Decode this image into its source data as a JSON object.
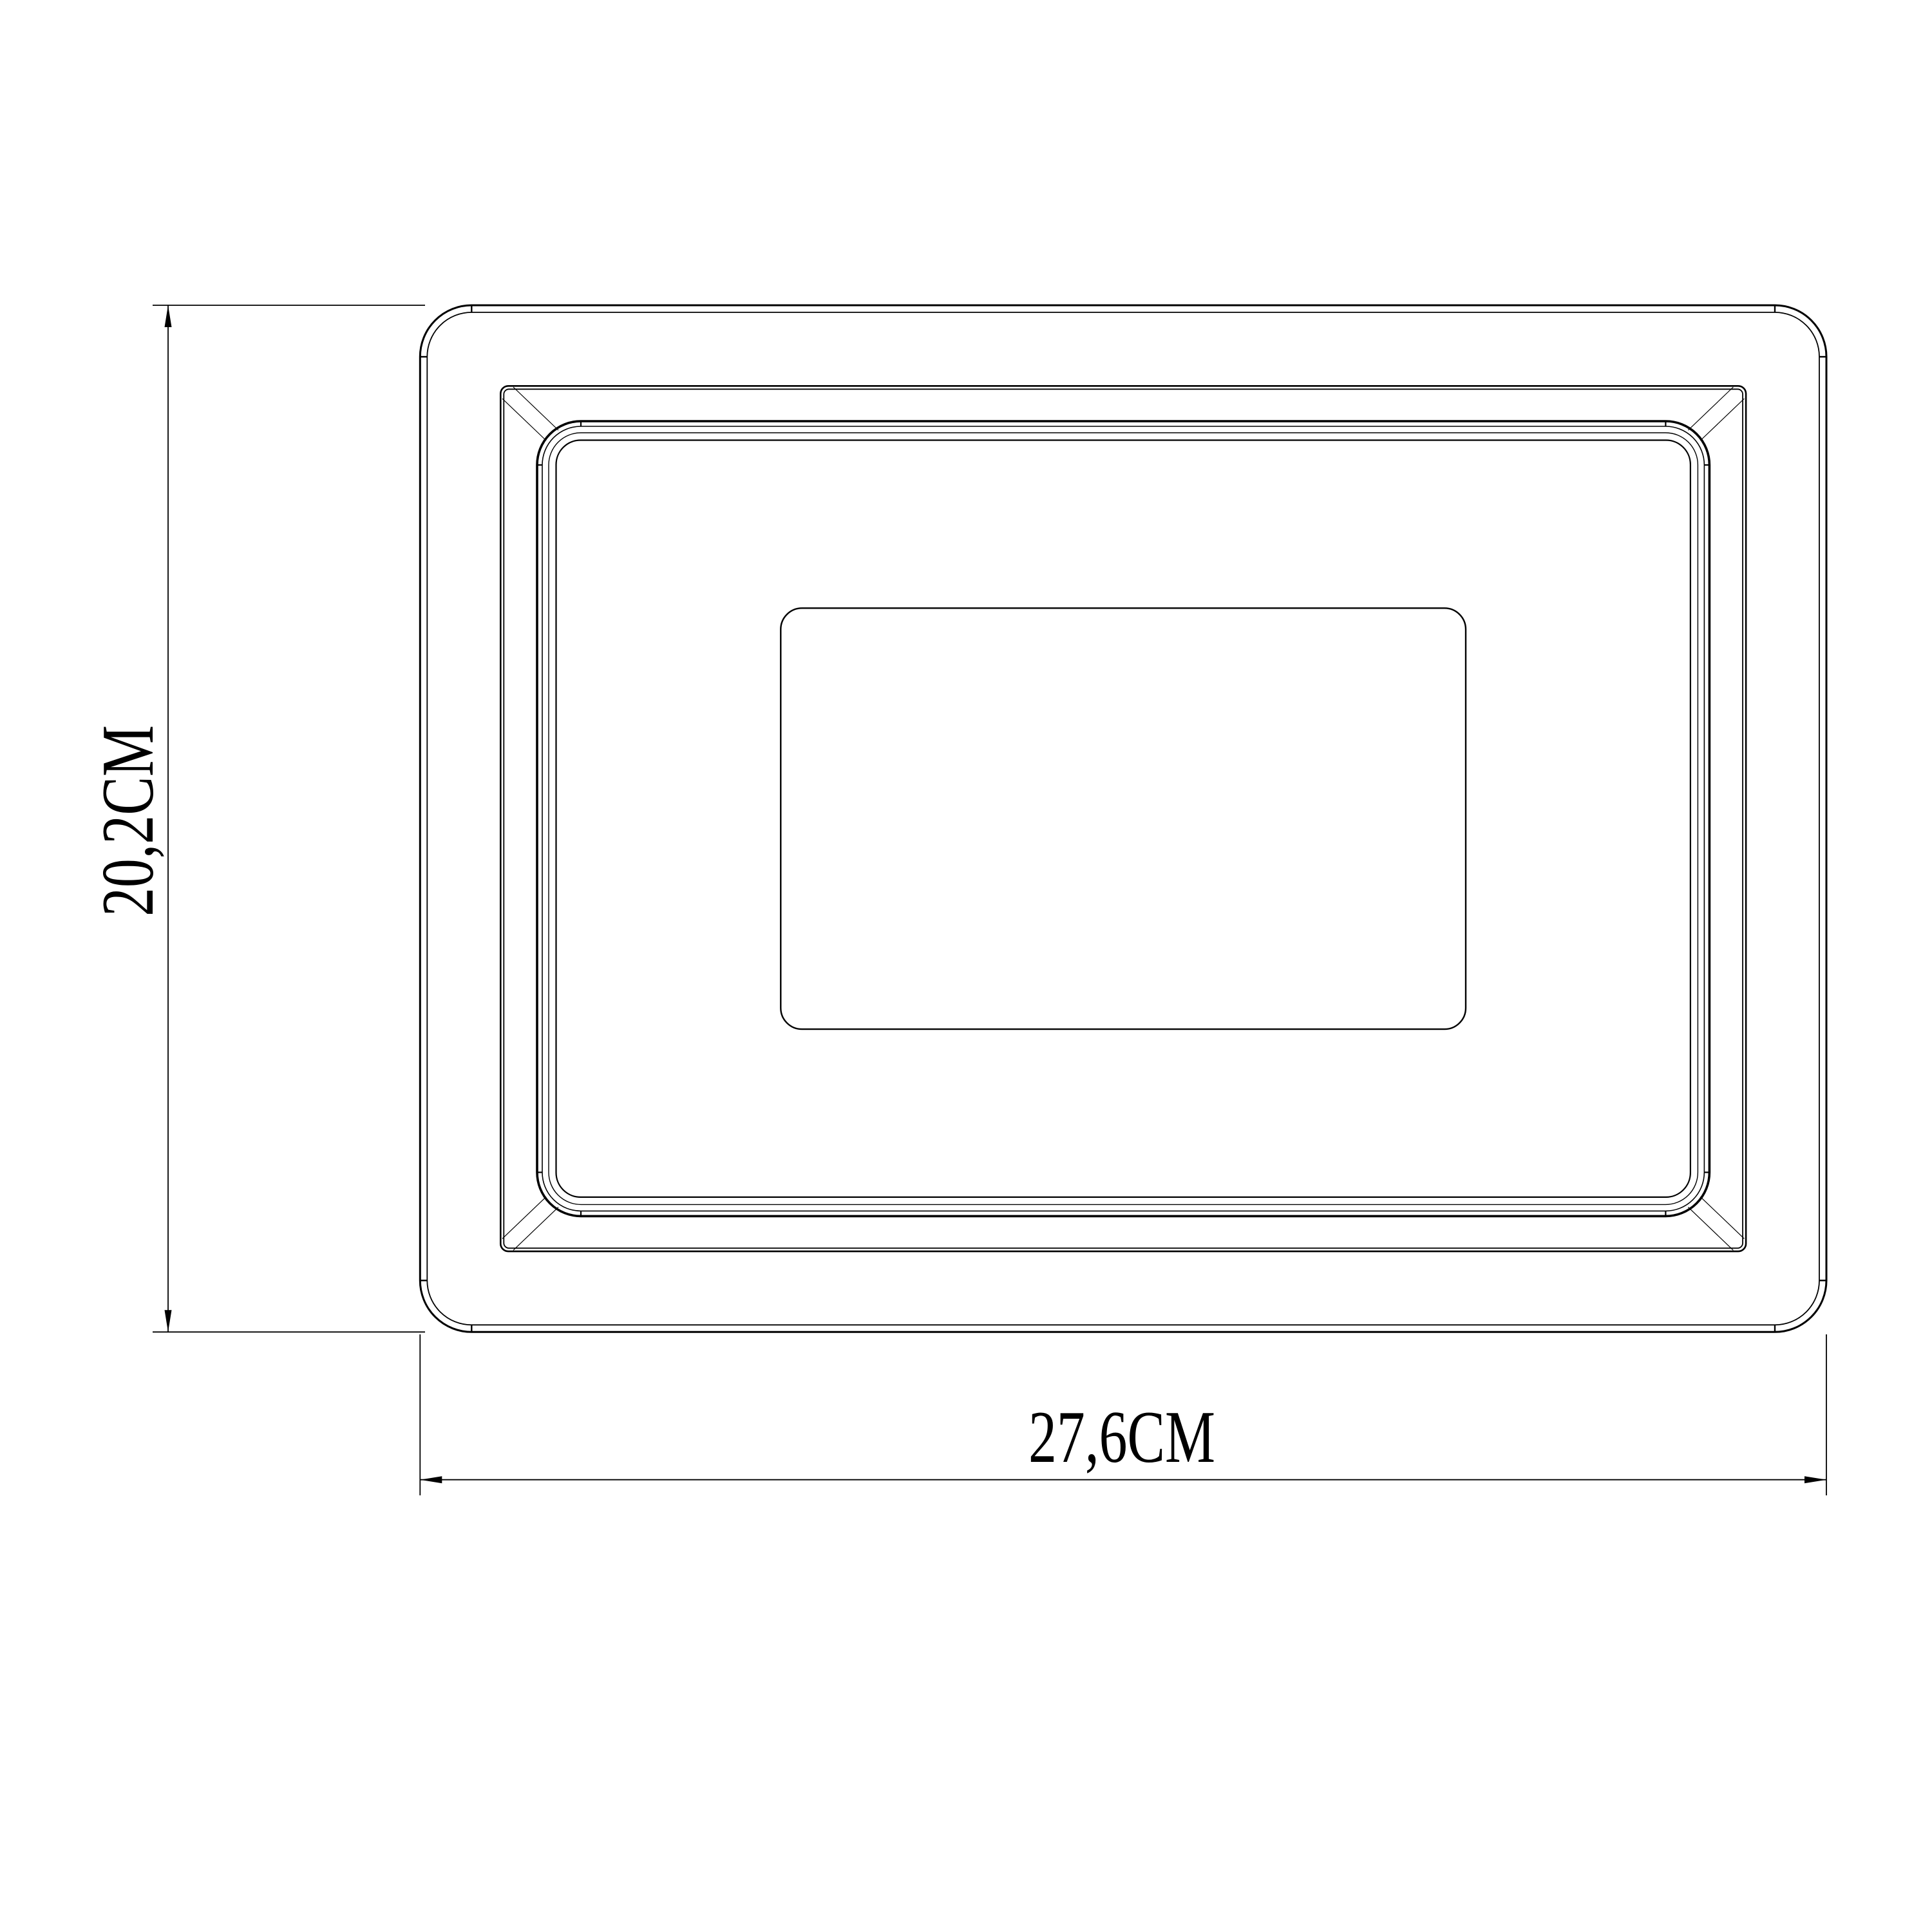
{
  "drawing": {
    "type": "technical-drawing-front-view",
    "subject": "rectangular-floodlight-frame",
    "background_color": "#ffffff",
    "line_color": "#000000",
    "dimensions": {
      "height": {
        "label": "20,2CM",
        "value_cm": 20.2,
        "orientation": "vertical",
        "position": "left"
      },
      "width": {
        "label": "27,6CM",
        "value_cm": 27.6,
        "orientation": "horizontal",
        "position": "bottom"
      }
    }
  }
}
